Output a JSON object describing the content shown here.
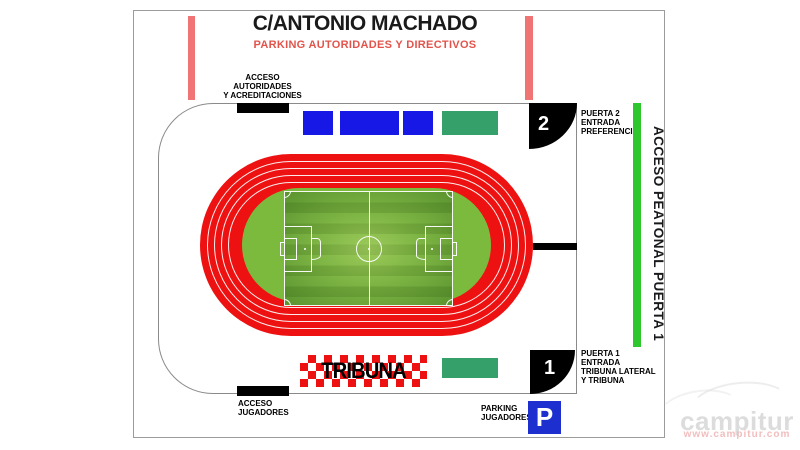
{
  "header": {
    "title": "C/ANTONIO MACHADO",
    "subtitle": "PARKING AUTORIDADES Y DIRECTIVOS"
  },
  "labels": {
    "acceso_autoridades": {
      "line1": "ACCESO",
      "line2": "AUTORIDADES",
      "line3": "Y ACREDITACIONES"
    },
    "acceso_jugadores": {
      "line1": "ACCESO",
      "line2": "JUGADORES"
    },
    "parking_jugadores": {
      "line1": "PARKING",
      "line2": "JUGADORES"
    },
    "acceso_peatonal": "ACCESO PEATONAL PUERTA 1",
    "tribuna": "TRIBUNA"
  },
  "gates": {
    "gate2": {
      "number": "2",
      "line1": "PUERTA 2",
      "line2": "ENTRADA",
      "line3": "PREFERENCIA"
    },
    "gate1": {
      "number": "1",
      "line1": "PUERTA 1",
      "line2": "ENTRADA",
      "line3": "TRIBUNA LATERAL",
      "line4": "Y TRIBUNA"
    }
  },
  "parking": {
    "symbol": "P"
  },
  "watermark": {
    "name": "campitur",
    "url": "www.campitur.com"
  },
  "colors": {
    "track_red": "#ee1111",
    "infield_green": "#7cba3e",
    "pitch_green": "#689f34",
    "block_blue": "#1717e6",
    "block_teal": "#35a06a",
    "pedestrian_green": "#2ec82e",
    "street_parking_salmon": "#f17474",
    "subtitle_red": "#e2544b",
    "parking_blue": "#1e2fd0"
  }
}
